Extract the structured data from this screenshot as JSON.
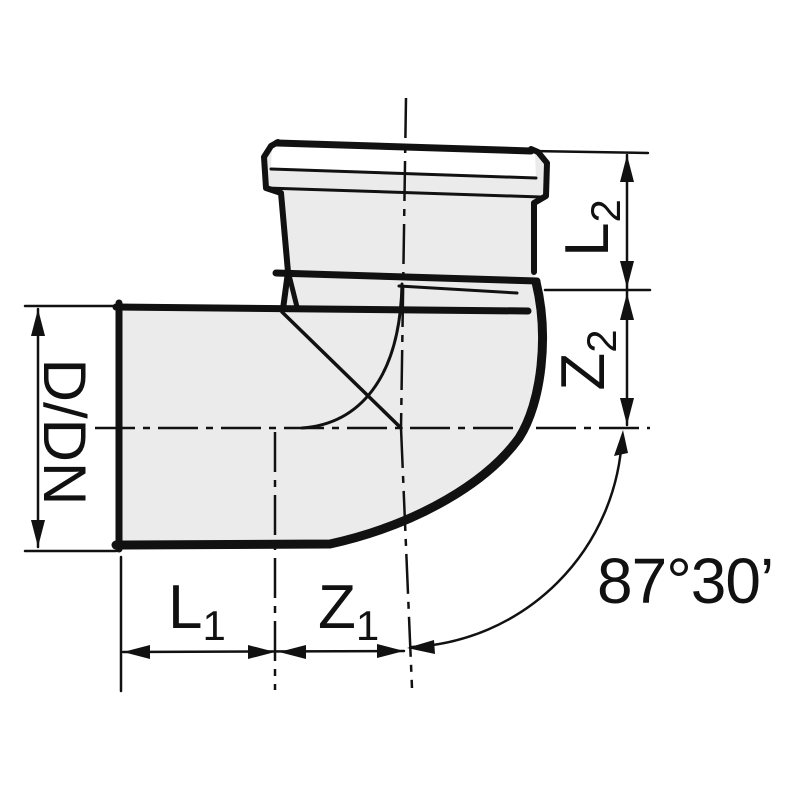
{
  "diagram": {
    "labels": {
      "diameter": "D/DN",
      "l1": {
        "base": "L",
        "sub": "1"
      },
      "z1": {
        "base": "Z",
        "sub": "1"
      },
      "l2": {
        "base": "L",
        "sub": "2"
      },
      "z2": {
        "base": "Z",
        "sub": "2"
      },
      "angle": "87°30’"
    },
    "colors": {
      "line": "#111111",
      "body_fill": "#ebebeb",
      "rim_band_fill": "#ffffff",
      "background": "#ffffff"
    }
  }
}
